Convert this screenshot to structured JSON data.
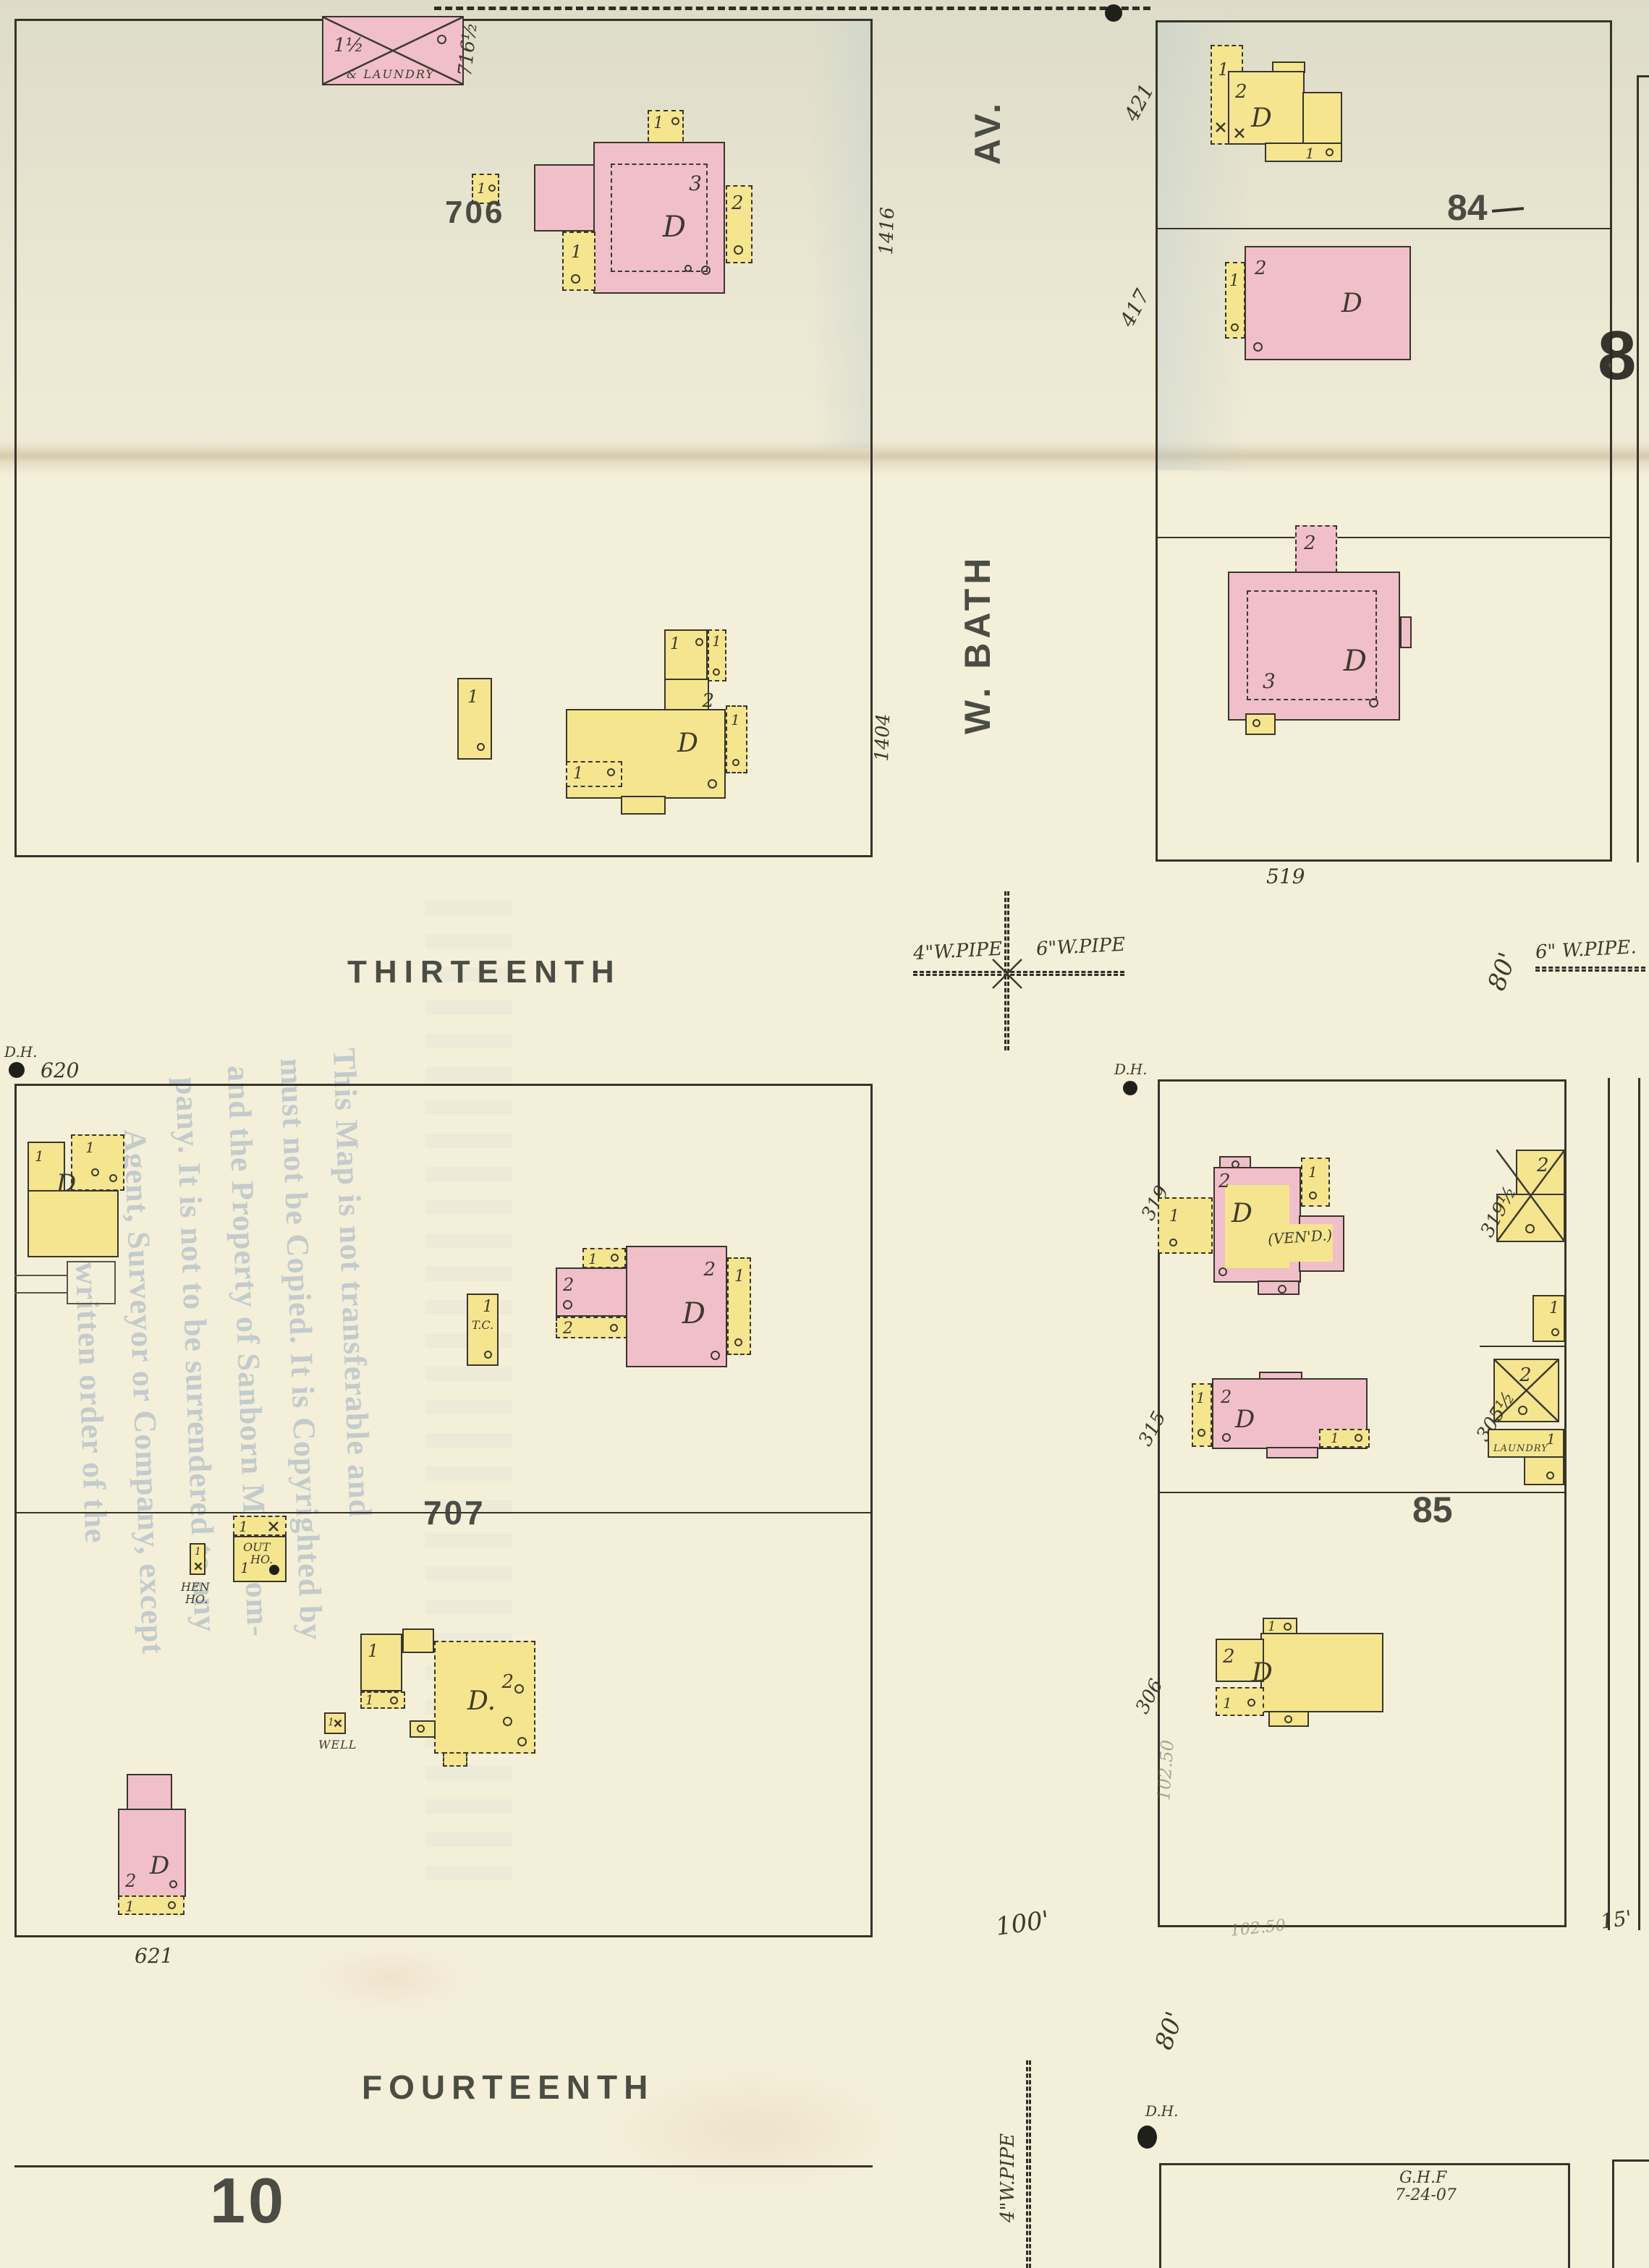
{
  "streets": {
    "thirteenth": "THIRTEENTH",
    "fourteenth": "FOURTEENTH",
    "w_bath": "W. BATH",
    "av": "AV."
  },
  "block_numbers": {
    "b706": "706",
    "b707": "707",
    "b84": "84",
    "b85": "85",
    "b10": "10",
    "sheet8": "8"
  },
  "house_numbers": {
    "n716h": "716½",
    "n1416": "1416",
    "n1404": "1404",
    "n421": "421",
    "n417": "417",
    "n519": "519",
    "n620": "620",
    "n621": "621",
    "n319": "319",
    "n315": "315",
    "n306": "306",
    "n319h": "319½",
    "n305h": "305½"
  },
  "dimensions": {
    "lot100": "100'",
    "lot80_thirteenth": "80'",
    "lot80_fourteenth": "80'",
    "lot15": "15'"
  },
  "pipes": {
    "w4_thirteenth": "4\"W.PIPE",
    "w6_thirteenth": "6\"W.PIPE",
    "w6_right": "6\" W.PIPE.",
    "w4_bottom": "4\"W.PIPE"
  },
  "markers": {
    "datum_hole": "D.H."
  },
  "story_labels": {
    "s1": "1",
    "s1h": "1½",
    "s2": "2",
    "s3": "3"
  },
  "building_labels": {
    "dwelling": "D",
    "dwelling_dot": "D.",
    "laundry_suffix": "& LAUNDRY",
    "laundry": "LAUNDRY",
    "out_house_1": "OUT",
    "out_house_2": "HO.",
    "hen_house_1": "HEN",
    "hen_house_2": "HO.",
    "well": "WELL",
    "trunk_room": "T.C.",
    "veneered": "(VEN'D.)"
  },
  "copyright_stamp": {
    "lines": [
      "This Map is not transferable and",
      "must not be Copied. It is Copyrighted by",
      "and the Property of Sanborn Map Com-",
      "pany. It is not to be surrendered to any",
      "Agent, Surveyor or Company, except",
      "upon written order of the"
    ]
  },
  "pencil_notes": {
    "price1": "102.50",
    "price2": "102.50"
  },
  "surveyor": {
    "initials": "G.H.F",
    "date": "7-24-07"
  },
  "colors": {
    "paper": "#f4efd9",
    "pink_building": "#f0bfc9",
    "yellow_building": "#f5e58f",
    "line_ink": "#36342a",
    "stamp_ink": "#3d4038",
    "blue_stamp": "#7a96b8",
    "pencil": "#706a58"
  }
}
